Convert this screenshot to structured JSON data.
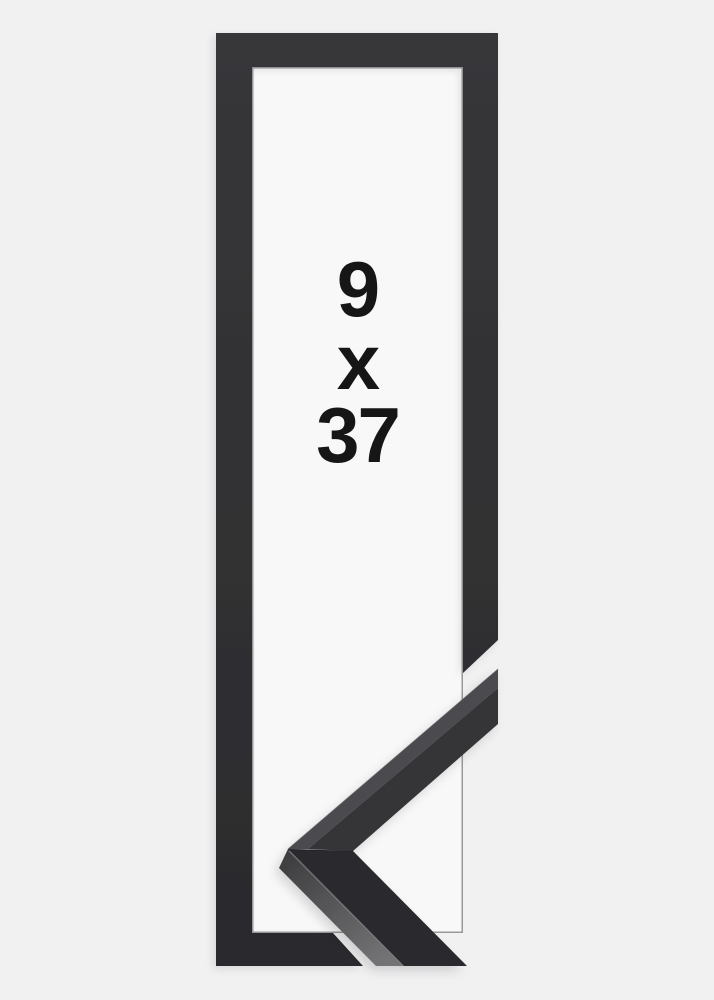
{
  "product": {
    "type_label": "picture-frame-product-image",
    "size": {
      "width_label": "9",
      "separator": "x",
      "height_label": "37"
    }
  },
  "colors": {
    "page_background": "#f1f1f2",
    "window_background": "#f8f8f8",
    "frame_top": "#37373a",
    "frame_bottom": "#2b2b2d",
    "frame_edge_highlight": "#4a4a4d",
    "sample_upper_face": "#343437",
    "sample_upper_side": "#4c4c4f",
    "sample_lower_face": "#2b2b2d",
    "sample_side_near_apex": "#3c3c3e",
    "sample_side_far": "#737375",
    "sample_crease_highlight": "#7a7a7d",
    "sample_miter_seam": "#1c1c1e",
    "text_color": "#161617"
  }
}
